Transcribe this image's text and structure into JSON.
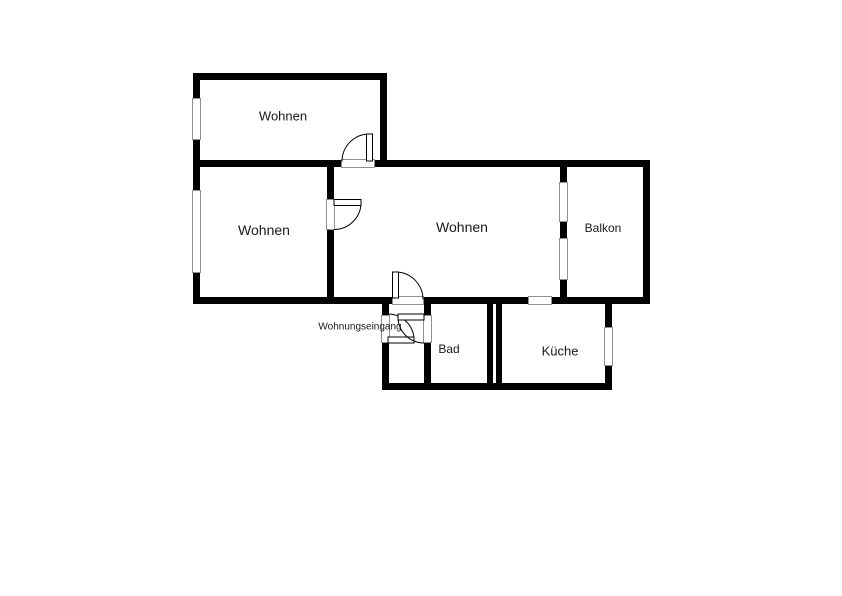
{
  "rooms": {
    "wohnen_top": {
      "label": "Wohnen"
    },
    "wohnen_left": {
      "label": "Wohnen"
    },
    "wohnen_main": {
      "label": "Wohnen"
    },
    "balkon": {
      "label": "Balkon"
    },
    "bad": {
      "label": "Bad"
    },
    "kueche": {
      "label": "Küche"
    },
    "entrance": {
      "label": "Wohnungseingang"
    }
  },
  "colors": {
    "wall": "#000000",
    "background": "#ffffff",
    "window_outline": "#8f8f8f",
    "text": "#1a1a1a"
  }
}
